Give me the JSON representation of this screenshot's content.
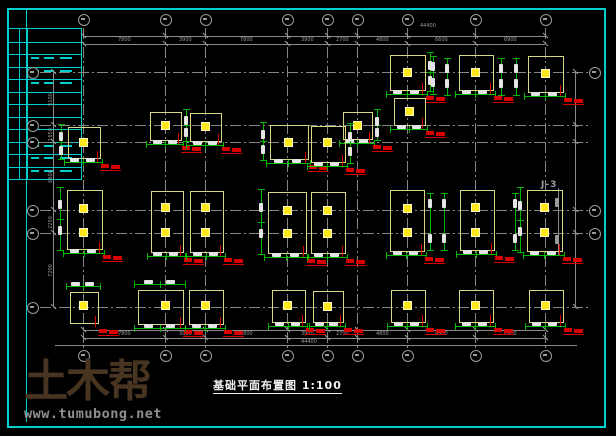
{
  "page": {
    "width": 616,
    "height": 436,
    "background": "#000000"
  },
  "frame": {
    "color": "#00cfcf",
    "outer_inset": 7,
    "inner_left_x": 26
  },
  "titleblock": {
    "x": 7,
    "y": 28,
    "w": 73,
    "h": 150,
    "rungs": 12,
    "col_lines_x": [
      18,
      26
    ],
    "text_band_rows": [
      [
        2,
        4
      ],
      [
        9,
        11
      ]
    ],
    "color": "#00cfcf"
  },
  "watermark": {
    "brand": "土木帮",
    "url": "www.tumubong.net",
    "brand_color": "#473521",
    "url_color": "#8f8f8f"
  },
  "drawing": {
    "title": "基础平面布置图",
    "scale": "1:100",
    "note_j3": "J-3",
    "colors": {
      "axis": "#858585",
      "pad_outline": "#d8d884",
      "column_fill": "#ffe81c",
      "dimension_bar": "#00b800",
      "dim_text_blob": "#e4e4e4",
      "label_red": "#d90000",
      "dim_gray_text": "#9a9a9a"
    },
    "axes": {
      "cols_x": [
        83,
        165,
        205,
        287,
        327,
        357,
        407,
        475,
        545
      ],
      "rows_y": [
        72,
        125,
        142,
        210,
        233,
        307
      ],
      "right_bubble_rows": [
        72,
        210,
        233
      ],
      "top_bubble_cy": 19,
      "bottom_bubble_cy": 355,
      "left_bubble_cx": 32,
      "right_bubble_cx": 594
    },
    "dims": {
      "top_total": "44400",
      "bottom_total": "44400",
      "top_chain": [
        7800,
        3900,
        7800,
        3900,
        2700,
        4800,
        6600,
        6900
      ],
      "left_chain": [
        5100,
        1650,
        6600,
        2250,
        7200
      ],
      "top_lines_y": [
        36,
        44
      ],
      "bottom_lines_y": [
        330,
        338
      ],
      "left_line_x": 53,
      "right_line_x": 575,
      "ground_line_y": 345
    },
    "footings": [
      {
        "cx": 407,
        "cy": 72,
        "w": 34,
        "h": 34,
        "cols": [
          [
            0,
            0
          ]
        ],
        "bars": [
          "b",
          "r"
        ]
      },
      {
        "cx": 475,
        "cy": 72,
        "w": 33,
        "h": 34,
        "cols": [
          [
            0,
            0
          ]
        ],
        "bars": [
          "b"
        ]
      },
      {
        "cx": 545,
        "cy": 73,
        "w": 34,
        "h": 35,
        "cols": [
          [
            0,
            0
          ]
        ],
        "bars": [
          "b"
        ]
      },
      {
        "cx": 409,
        "cy": 111,
        "w": 30,
        "h": 26,
        "cols": [
          [
            0,
            0
          ]
        ],
        "bars": [
          "b"
        ]
      },
      {
        "cx": 165,
        "cy": 125,
        "w": 30,
        "h": 27,
        "cols": [
          [
            0,
            0
          ]
        ],
        "bars": [
          "b",
          "r"
        ]
      },
      {
        "cx": 205,
        "cy": 126,
        "w": 30,
        "h": 27,
        "cols": [
          [
            0,
            0
          ]
        ],
        "bars": [
          "b"
        ]
      },
      {
        "cx": 357,
        "cy": 125,
        "w": 28,
        "h": 26,
        "cols": [
          [
            0,
            0
          ]
        ],
        "bars": [
          "b",
          "r"
        ]
      },
      {
        "cx": 83,
        "cy": 142,
        "w": 31,
        "h": 30,
        "cols": [
          [
            0,
            0
          ]
        ],
        "bars": [
          "b",
          "l"
        ]
      },
      {
        "cx": 288,
        "cy": 141,
        "w": 37,
        "h": 33,
        "cols": [
          [
            0,
            1
          ]
        ],
        "bars": [
          "b",
          "l"
        ]
      },
      {
        "cx": 327,
        "cy": 143,
        "w": 33,
        "h": 35,
        "cols": [
          [
            0,
            -1
          ]
        ],
        "bars": [
          "b",
          "r"
        ]
      },
      {
        "cx": 84,
        "cy": 219,
        "w": 34,
        "h": 58,
        "cols": [
          [
            -1,
            -11
          ],
          [
            -1,
            13
          ]
        ],
        "bars": [
          "b",
          "l"
        ]
      },
      {
        "cx": 166,
        "cy": 221,
        "w": 31,
        "h": 60,
        "cols": [
          [
            -1,
            -14
          ],
          [
            -1,
            11
          ]
        ],
        "bars": [
          "b"
        ]
      },
      {
        "cx": 206,
        "cy": 221,
        "w": 32,
        "h": 60,
        "cols": [
          [
            -1,
            -14
          ],
          [
            -1,
            11
          ]
        ],
        "bars": [
          "b"
        ]
      },
      {
        "cx": 286,
        "cy": 222,
        "w": 37,
        "h": 60,
        "cols": [
          [
            1,
            -12
          ],
          [
            1,
            11
          ]
        ],
        "bars": [
          "b",
          "l"
        ]
      },
      {
        "cx": 327,
        "cy": 222,
        "w": 33,
        "h": 60,
        "cols": [
          [
            0,
            -12
          ],
          [
            0,
            11
          ]
        ],
        "bars": [
          "b"
        ]
      },
      {
        "cx": 406,
        "cy": 220,
        "w": 33,
        "h": 60,
        "cols": [
          [
            1,
            -12
          ],
          [
            1,
            12
          ]
        ],
        "bars": [
          "b"
        ]
      },
      {
        "cx": 476,
        "cy": 219,
        "w": 33,
        "h": 59,
        "cols": [
          [
            -1,
            -12
          ],
          [
            -1,
            13
          ]
        ],
        "bars": [
          "b"
        ]
      },
      {
        "cx": 544,
        "cy": 220,
        "w": 34,
        "h": 60,
        "cols": [
          [
            0,
            -13
          ],
          [
            0,
            12
          ]
        ],
        "bars": [
          "b",
          "l"
        ]
      },
      {
        "cx": 83,
        "cy": 307,
        "w": 27,
        "h": 30,
        "cols": [
          [
            0,
            -2
          ]
        ],
        "bars": [
          "t"
        ]
      },
      {
        "cx": 160,
        "cy": 306,
        "w": 44,
        "h": 33,
        "cols": [
          [
            5,
            -1
          ]
        ],
        "bars": [
          "t",
          "b"
        ]
      },
      {
        "cx": 205,
        "cy": 306,
        "w": 33,
        "h": 33,
        "cols": [
          [
            0,
            -1
          ]
        ],
        "bars": [
          "b"
        ]
      },
      {
        "cx": 288,
        "cy": 305,
        "w": 32,
        "h": 31,
        "cols": [
          [
            -1,
            0
          ]
        ],
        "bars": [
          "b"
        ]
      },
      {
        "cx": 327,
        "cy": 306,
        "w": 29,
        "h": 30,
        "cols": [
          [
            0,
            0
          ]
        ],
        "bars": [
          "b"
        ]
      },
      {
        "cx": 407,
        "cy": 305,
        "w": 33,
        "h": 31,
        "cols": [
          [
            0,
            0
          ]
        ],
        "bars": [
          "b"
        ]
      },
      {
        "cx": 475,
        "cy": 305,
        "w": 33,
        "h": 31,
        "cols": [
          [
            0,
            0
          ]
        ],
        "bars": [
          "b"
        ]
      },
      {
        "cx": 545,
        "cy": 305,
        "w": 33,
        "h": 31,
        "cols": [
          [
            0,
            0
          ]
        ],
        "bars": [
          "b"
        ]
      }
    ],
    "extra_vbars": [
      {
        "x": 433,
        "y1": 56,
        "y2": 94
      },
      {
        "x": 447,
        "y1": 58,
        "y2": 95
      },
      {
        "x": 501,
        "y1": 58,
        "y2": 95
      },
      {
        "x": 516,
        "y1": 58,
        "y2": 95
      },
      {
        "x": 430,
        "y1": 193,
        "y2": 250
      },
      {
        "x": 444,
        "y1": 193,
        "y2": 250
      },
      {
        "x": 515,
        "y1": 193,
        "y2": 250
      }
    ],
    "right_dim_bar": {
      "x": 558,
      "y1": 188,
      "y2": 255
    }
  }
}
